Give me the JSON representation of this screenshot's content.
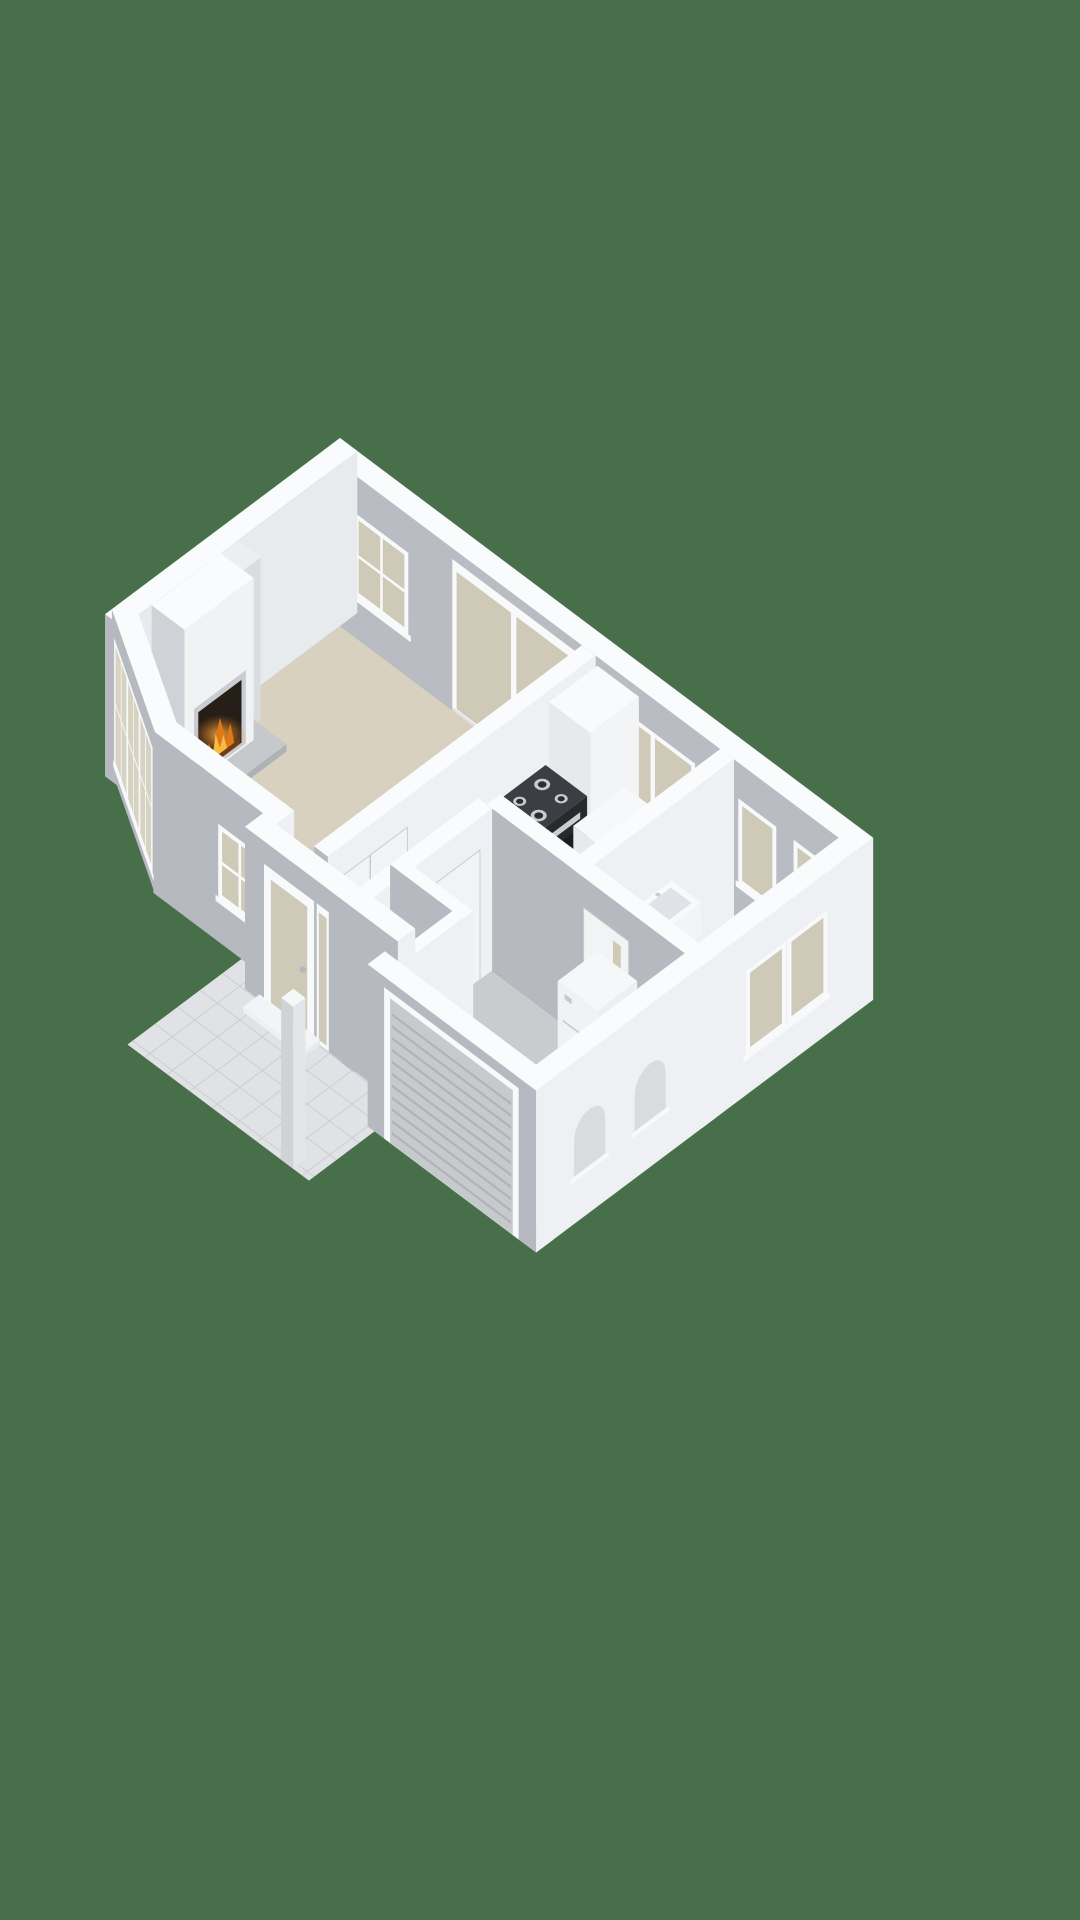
{
  "meta": {
    "kind": "3d-floorplan-render",
    "view": "isometric",
    "background": "grass-green"
  },
  "colors": {
    "bg": "#47704a",
    "wallTop": "#fafbfc",
    "wallFaceX": "#eef0f3",
    "wallFaceY": "#b6bac0",
    "innerNE": "#b9bdc3",
    "innerNW": "#e8ebee",
    "furTop": "#f9fafb",
    "furX": "#f2f4f6",
    "furY": "#e7e9ec",
    "floorBeige": "#d8d1c0",
    "floorGray": "#c9cbce",
    "floorWC": "#c6c8cb",
    "tile": "#e0e2e5",
    "tileLine": "#cbced2",
    "frame": "#f8f9fa",
    "frameShade": "#e0e3e6",
    "frosted": "#cfc9b8",
    "glassClear": "#d8d2c2",
    "doorLeaf": "#f2f3f5",
    "doorLine": "#c9ccce",
    "handle": "#b4b8bc",
    "steel": "#c9ccd0",
    "stoveTop": "#3b3e42",
    "ovenFront": "#27292c",
    "ovenWin": "#1a1c1e",
    "stoveSide": "#303236",
    "counterTop": "#f7f8fa",
    "sink": "#d4d7da",
    "ribDoor": "#c6cacd",
    "ribLine": "#b0b4b8",
    "vent": "#d9dcdf",
    "fireDark": "#261f18",
    "flame1": "#e07818",
    "flame2": "#f6bc42",
    "ember": "#6e3d18",
    "hearth": "#aeb2b6",
    "hearthTop": "#c6c9cc",
    "boilerTop": "#f6f7f9",
    "boilerX": "#edeff1",
    "boilerY": "#f1f2f4",
    "boilerLine": "#c7cacd",
    "thresholdTop": "#f3f4f6"
  },
  "scene": {
    "projection": {
      "ox": 340,
      "oy": 600,
      "kx": 0.864,
      "ky": 0.648,
      "zs": 1.08
    },
    "drawlist": [
      {
        "t": "floor",
        "name": "living-room-floor",
        "fill": "floorBeige",
        "pts": [
          [
            20,
            20
          ],
          [
            300,
            20
          ],
          [
            300,
            314
          ],
          [
            126,
            314
          ],
          [
            20,
            252
          ]
        ]
      },
      {
        "t": "floor",
        "name": "kitchen-floor",
        "fill": "floorBeige",
        "pts": [
          [
            316,
            20
          ],
          [
            460,
            20
          ],
          [
            460,
            182
          ],
          [
            316,
            182
          ]
        ]
      },
      {
        "t": "floor",
        "name": "wc-floor",
        "fill": "floorWC",
        "pts": [
          [
            476,
            20
          ],
          [
            597,
            20
          ],
          [
            597,
            182
          ],
          [
            476,
            182
          ]
        ]
      },
      {
        "t": "floor",
        "name": "hallway-floor",
        "fill": "floorBeige",
        "pts": [
          [
            316,
            198
          ],
          [
            358,
            198
          ],
          [
            358,
            335
          ],
          [
            261,
            335
          ],
          [
            261,
            314
          ],
          [
            316,
            314
          ]
        ]
      },
      {
        "t": "floor",
        "name": "garage-floor",
        "fill": "floorGray",
        "pts": [
          [
            374,
            198
          ],
          [
            597,
            198
          ],
          [
            597,
            370
          ],
          [
            374,
            370
          ]
        ]
      },
      {
        "t": "floor",
        "name": "meter-closet-floor",
        "fill": "floorBeige",
        "pts": [
          [
            374,
            300
          ],
          [
            430,
            300
          ],
          [
            430,
            356
          ],
          [
            374,
            356
          ]
        ]
      },
      {
        "t": "tiles",
        "name": "porch-tiles",
        "fill": "tile",
        "line": "tileLine",
        "sx": 26,
        "sy": 26,
        "pts": [
          [
            220,
            334
          ],
          [
            245,
            334
          ],
          [
            245,
            355
          ],
          [
            430,
            355
          ],
          [
            430,
            466
          ],
          [
            220,
            466
          ]
        ],
        "x0": 214,
        "x1": 436,
        "y0": 330,
        "y1": 470
      },
      {
        "t": "box",
        "name": "wall-northeast",
        "r": [
          0,
          0,
          617,
          20
        ],
        "z": [
          0,
          150
        ],
        "c": {
          "top": "wallTop",
          "px": "wallFaceX",
          "py": "innerNE"
        },
        "ov": [
          {
            "f": "py",
            "k": "sash2",
            "u0": 40,
            "u1": 96,
            "z0": 42,
            "z1": 112
          },
          {
            "f": "py",
            "k": "slider",
            "u0": 150,
            "u1": 292,
            "z0": 0,
            "z1": 140
          },
          {
            "f": "py",
            "k": "frosted2",
            "u0": 336,
            "u1": 428,
            "z0": 46,
            "z1": 116
          },
          {
            "f": "py",
            "k": "frosted",
            "u0": 484,
            "u1": 522,
            "z0": 42,
            "z1": 114
          },
          {
            "f": "py",
            "k": "frosted",
            "u0": 548,
            "u1": 586,
            "z0": 42,
            "z1": 114
          }
        ]
      },
      {
        "t": "box",
        "name": "wall-northwest",
        "r": [
          0,
          0,
          20,
          272
        ],
        "z": [
          0,
          150
        ],
        "c": {
          "top": "wallTop",
          "px": "innerNW",
          "py": "wallFaceY"
        }
      },
      {
        "t": "box",
        "name": "fireplace-side-fin",
        "r": [
          20,
          138,
          46,
          158
        ],
        "z": [
          0,
          150
        ],
        "c": {
          "top": "#eceef0",
          "px": "#dadde0",
          "py": "#c3c7cb"
        }
      },
      {
        "t": "box",
        "name": "fireplace-hearth",
        "r": [
          20,
          148,
          86,
          246
        ],
        "z": [
          0,
          7
        ],
        "c": {
          "top": "hearthTop",
          "px": "hearth",
          "py": "hearth"
        }
      },
      {
        "t": "box",
        "name": "fireplace-chimney-breast",
        "r": [
          20,
          158,
          58,
          238
        ],
        "z": [
          0,
          150
        ],
        "c": {
          "top": "wallTop",
          "px": "#f0f2f4",
          "py": "#cfd3d7"
        },
        "ov": [
          {
            "f": "px",
            "k": "firebox",
            "u0": 172,
            "u1": 222,
            "z0": 6,
            "z1": 64
          }
        ]
      },
      {
        "t": "box",
        "name": "wall-living-hall",
        "r": [
          300,
          20,
          316,
          330
        ],
        "z": [
          0,
          150
        ],
        "c": {
          "top": "wallTop",
          "px": "wallFaceX",
          "py": "wallFaceY"
        },
        "ov": [
          {
            "f": "px",
            "k": "door2",
            "u0": 238,
            "u1": 324,
            "z0": 0,
            "z1": 122
          }
        ]
      },
      {
        "t": "box",
        "name": "kitchen-tall-cabinet",
        "r": [
          318,
          20,
          366,
          76
        ],
        "z": [
          0,
          142
        ],
        "c": {
          "top": "furTop",
          "px": "furX",
          "py": "furY"
        }
      },
      {
        "t": "box",
        "name": "kitchen-stove",
        "r": [
          318,
          80,
          366,
          140
        ],
        "z": [
          0,
          86
        ],
        "c": {
          "top": "stoveTop",
          "px": "ovenFront",
          "py": "stoveSide"
        },
        "ov": [
          {
            "f": "px",
            "k": "rect",
            "u0": 88,
            "u1": 132,
            "z0": 70,
            "z1": 76,
            "fill": "steel"
          },
          {
            "f": "px",
            "k": "rect",
            "u0": 90,
            "u1": 130,
            "z0": 28,
            "z1": 62,
            "fill": "ovenWin"
          }
        ],
        "dots": [
          {
            "x": 331,
            "y": 97,
            "r": 8,
            "fill": "steel",
            "inner": "#2c2e31"
          },
          {
            "x": 353,
            "y": 97,
            "r": 6.5,
            "fill": "steel",
            "inner": "#2c2e31"
          },
          {
            "x": 331,
            "y": 123,
            "r": 6.5,
            "fill": "steel",
            "inner": "#2c2e31"
          },
          {
            "x": 353,
            "y": 123,
            "r": 8,
            "fill": "steel",
            "inner": "#2c2e31"
          }
        ]
      },
      {
        "t": "box",
        "name": "kitchen-counter",
        "r": [
          366,
          36,
          452,
          96
        ],
        "z": [
          0,
          68
        ],
        "c": {
          "top": "counterTop",
          "px": "furX",
          "py": "furY"
        },
        "inset": {
          "x0": 404,
          "y0": 46,
          "x1": 446,
          "y1": 86,
          "fill": "sink"
        }
      },
      {
        "t": "box",
        "name": "wall-kitchen-wc",
        "r": [
          460,
          20,
          476,
          182
        ],
        "z": [
          0,
          150
        ],
        "c": {
          "top": "wallTop",
          "px": "wallFaceX",
          "py": "wallFaceY"
        }
      },
      {
        "t": "box",
        "name": "wc-basin",
        "r": [
          480,
          96,
          514,
          134
        ],
        "z": [
          56,
          86
        ],
        "c": {
          "top": "#f8f9fa",
          "px": "furX",
          "py": "furY"
        },
        "inset": {
          "x0": 485,
          "y0": 102,
          "x1": 509,
          "y1": 128,
          "fill": "#dfe2e6"
        },
        "dots": [
          {
            "x": 483,
            "y": 115,
            "r": 2.6,
            "fill": "steel"
          }
        ]
      },
      {
        "t": "box",
        "name": "wall-garage-north",
        "r": [
          368,
          182,
          617,
          198
        ],
        "z": [
          0,
          150
        ],
        "c": {
          "top": "wallTop",
          "px": "wallFaceX",
          "py": "wallFaceY"
        },
        "ov": [
          {
            "f": "py",
            "k": "doorglass",
            "u0": 480,
            "u1": 532,
            "z0": 0,
            "z1": 122
          }
        ]
      },
      {
        "t": "box",
        "name": "garage-boiler",
        "r": [
          500,
          202,
          546,
          248
        ],
        "z": [
          0,
          96
        ],
        "c": {
          "top": "boilerTop",
          "px": "boilerX",
          "py": "boilerY"
        },
        "ov": [
          {
            "f": "py",
            "k": "hline",
            "u0": 506,
            "u1": 540,
            "z0": 34,
            "fill": "boilerLine"
          },
          {
            "f": "py",
            "k": "hline",
            "u0": 506,
            "u1": 540,
            "z0": 62,
            "fill": "boilerLine"
          },
          {
            "f": "py",
            "k": "rect",
            "u0": 508,
            "u1": 516,
            "z0": 84,
            "z1": 89,
            "fill": "boilerLine"
          }
        ]
      },
      {
        "t": "box",
        "name": "wall-hall-garage",
        "r": [
          358,
          198,
          374,
          356
        ],
        "z": [
          0,
          150
        ],
        "c": {
          "top": "wallTop",
          "px": "wallFaceX",
          "py": "wallFaceY"
        },
        "ov": [
          {
            "f": "px",
            "k": "door",
            "u0": 212,
            "u1": 268,
            "z0": 0,
            "z1": 120
          }
        ]
      },
      {
        "t": "box",
        "name": "meter-closet-wall-north",
        "r": [
          358,
          288,
          442,
          300
        ],
        "z": [
          0,
          150
        ],
        "c": {
          "top": "wallTop",
          "px": "wallFaceX",
          "py": "wallFaceY"
        }
      },
      {
        "t": "box",
        "name": "meter-closet-panel",
        "r": [
          378,
          302,
          404,
          334
        ],
        "z": [
          0,
          60
        ],
        "c": {
          "top": "#494c50",
          "px": "#37393c",
          "py": "#404347"
        },
        "slats": true
      },
      {
        "t": "box",
        "name": "meter-closet-crate",
        "r": [
          380,
          336,
          394,
          350
        ],
        "z": [
          0,
          24
        ],
        "c": {
          "top": "#b4763f",
          "px": "#9a5f30",
          "py": "#a86a38"
        }
      },
      {
        "t": "box",
        "name": "meter-closet-divider",
        "r": [
          404,
          300,
          412,
          356
        ],
        "z": [
          0,
          96
        ],
        "c": {
          "top": "wallTop",
          "px": "wallFaceX",
          "py": "wallFaceY"
        }
      },
      {
        "t": "box",
        "name": "meter-closet-wall-east",
        "r": [
          430,
          288,
          442,
          356
        ],
        "z": [
          0,
          150
        ],
        "c": {
          "top": "wallTop",
          "px": "wallFaceX",
          "py": "wallFaceY"
        }
      },
      {
        "t": "box",
        "name": "wall-living-front",
        "r": [
          118,
          314,
          253,
          334
        ],
        "z": [
          0,
          150
        ],
        "c": {
          "top": "wallTop",
          "px": "wallFaceX",
          "py": "wallFaceY"
        },
        "ov": [
          {
            "f": "py",
            "k": "sash2",
            "u0": 196,
            "u1": 240,
            "z0": 44,
            "z1": 106
          }
        ]
      },
      {
        "t": "prism",
        "name": "wall-chamfer-bay",
        "a": [
          0,
          264
        ],
        "b": [
          120,
          334
        ],
        "a2": [
          10,
          247
        ],
        "b2": [
          130,
          317
        ],
        "h": 150,
        "face": "wallFaceY",
        "top": "wallTop",
        "ov": {
          "k": "gridbig",
          "u0": 10,
          "u1": 128,
          "z0": 16,
          "z1": 126
        }
      },
      {
        "t": "box",
        "name": "wall-entry-jog",
        "r": [
          245,
          314,
          261,
          355
        ],
        "z": [
          0,
          150
        ],
        "c": {
          "top": "wallTop",
          "px": "wallFaceX",
          "py": "wallFaceY"
        }
      },
      {
        "t": "box",
        "name": "wall-entry-front",
        "r": [
          245,
          335,
          422,
          355
        ],
        "z": [
          0,
          150
        ],
        "c": {
          "top": "wallTop",
          "px": "wallFaceX",
          "py": "wallFaceY"
        },
        "ov": [
          {
            "f": "py",
            "k": "frontdoor",
            "u0": 270,
            "u1": 322,
            "z0": 0,
            "z1": 126
          },
          {
            "f": "py",
            "k": "sidelight",
            "u0": 328,
            "u1": 342,
            "z0": 0,
            "z1": 126
          }
        ]
      },
      {
        "t": "box",
        "name": "entry-threshold-step",
        "r": [
          262,
          355,
          332,
          374
        ],
        "z": [
          0,
          5
        ],
        "c": {
          "top": "thresholdTop",
          "px": "#e8eaec",
          "py": "#eef0f2"
        }
      },
      {
        "t": "box",
        "name": "wall-garage-front",
        "r": [
          422,
          370,
          617,
          390
        ],
        "z": [
          0,
          150
        ],
        "c": {
          "top": "wallTop",
          "px": "wallFaceX",
          "py": "wallFaceY"
        },
        "ov": [
          {
            "f": "py",
            "k": "garage",
            "u0": 448,
            "u1": 590,
            "z0": 0,
            "z1": 134
          }
        ]
      },
      {
        "t": "box",
        "name": "wall-southeast",
        "r": [
          597,
          0,
          617,
          390
        ],
        "z": [
          0,
          150
        ],
        "c": {
          "top": "wallTop",
          "px": "wallFaceX",
          "py": "wallFaceY"
        },
        "ov": [
          {
            "f": "px",
            "k": "frosted",
            "u0": 56,
            "u1": 96,
            "z0": 40,
            "z1": 112
          },
          {
            "f": "px",
            "k": "frosted",
            "u0": 104,
            "u1": 144,
            "z0": 40,
            "z1": 112
          },
          {
            "f": "px",
            "k": "vent",
            "u0": 240,
            "u1": 276,
            "z0": 44,
            "z1": 96
          },
          {
            "f": "px",
            "k": "vent",
            "u0": 310,
            "u1": 346,
            "z0": 44,
            "z1": 96
          }
        ]
      },
      {
        "t": "box",
        "name": "porch-pillar",
        "r": [
          398,
          452,
          412,
          466
        ],
        "z": [
          0,
          150
        ],
        "c": {
          "top": "#f6f7f9",
          "px": "#e3e6e9",
          "py": "#cfd3d6"
        }
      }
    ]
  }
}
